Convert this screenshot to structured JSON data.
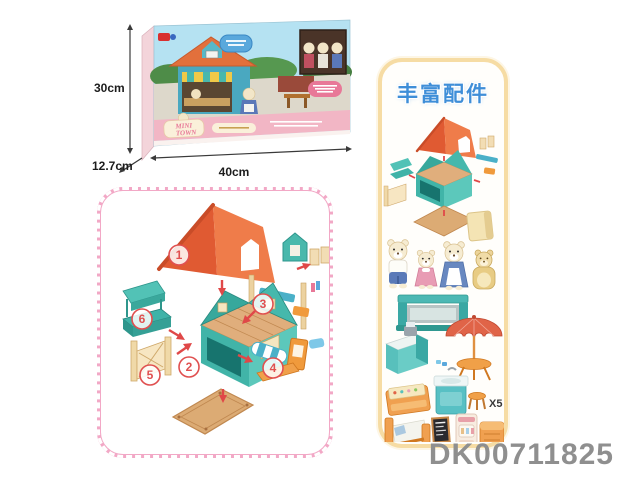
{
  "product": {
    "code": "DK00711825",
    "brand_line1": "MINI",
    "brand_line2": "TOWN"
  },
  "box": {
    "dimensions": {
      "height": "30cm",
      "depth": "12.7cm",
      "width": "40cm"
    }
  },
  "assembly": {
    "parts": [
      {
        "number": "1",
        "name": "roof"
      },
      {
        "number": "2",
        "name": "house body"
      },
      {
        "number": "3",
        "name": "dormer and window frames"
      },
      {
        "number": "4",
        "name": "shop sign and awning"
      },
      {
        "number": "5",
        "name": "fence"
      },
      {
        "number": "6",
        "name": "awning counter"
      }
    ]
  },
  "accessories": {
    "title": "丰富配件",
    "stool_quantity": "X5",
    "items": [
      "house kit",
      "storage box",
      "papa bear",
      "kid bear",
      "mama bear",
      "honey bear",
      "display stand",
      "cash counter",
      "parasol table",
      "show counter",
      "sink unit",
      "stool",
      "bed",
      "menu chalkboard",
      "vending machine",
      "storage chest"
    ]
  },
  "colors": {
    "panel_pink": "#f2a8c6",
    "panel_yellow": "#f6dca4",
    "accent_blue": "#3e8ed8",
    "roof_orange": "#e8653a",
    "house_teal": "#46b8ac",
    "code_gray": "#8f8f8f",
    "arrow_red": "#e04848"
  }
}
